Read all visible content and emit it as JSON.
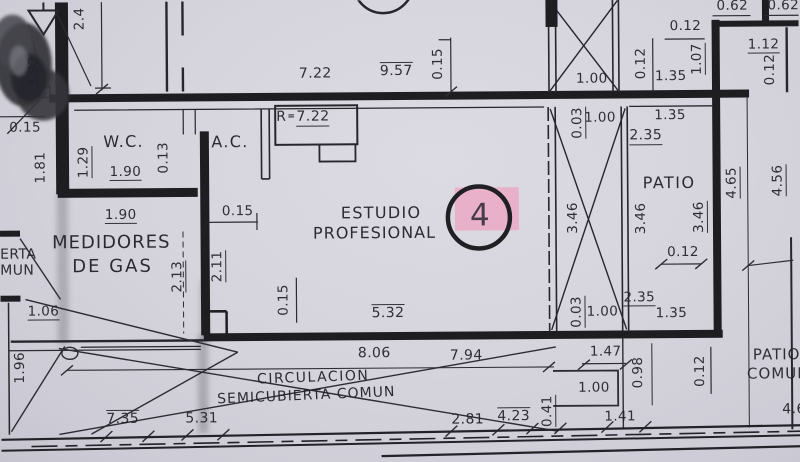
{
  "texts": {
    "wc": "W.C.",
    "ac": "A.C.",
    "estudio_1": "ESTUDIO",
    "estudio_2": "PROFESIONAL",
    "unit_number": "4",
    "medidores_1": "MEDIDORES",
    "medidores_2": "DE GAS",
    "patio": "PATIO",
    "circulacion_1": "CIRCULACION",
    "circulacion_2": "SEMICUBIERTA COMUN",
    "patio_comun_1": "PATIO",
    "patio_comun_2": "COMUN",
    "edge_erta": "ERTA",
    "edge_mun": "MUN",
    "radius_prefix": "R",
    "radius_eq": "=",
    "radius_value": "7.22"
  },
  "dims": {
    "top_24": "2.4",
    "top_722": "7.22",
    "top_957": "9.57",
    "top_015": "0.15",
    "tr_062_a": "0.62",
    "tr_062_b": "0.62",
    "tr_012_a": "0.12",
    "tr_012_b": "0.12",
    "tr_107": "1.07",
    "tr_135": "1.35",
    "tr_100": "1.00",
    "tr_112": "1.12",
    "tr_012_c": "0.12",
    "left_382": "3.82",
    "left_015": "0.15",
    "left_181": "1.81",
    "wc_129": "1.29",
    "wc_190": "1.90",
    "wc_013": "0.13",
    "med_190": "1.90",
    "med_213": "2.13",
    "med_106": "1.06",
    "med_196": "1.96",
    "ac_015": "0.15",
    "est_211": "2.11",
    "est_015": "0.15",
    "est_532": "5.32",
    "sh_003_t": "0.03",
    "sh_100_t": "1.00",
    "sh_346": "3.46",
    "pa_135_t": "1.35",
    "pa_235_t": "2.35",
    "pa_346_a": "3.46",
    "pa_346_b": "3.46",
    "pa_012": "0.12",
    "pa_235_b": "2.35",
    "pa_135_b": "1.35",
    "sh_003_b": "0.03",
    "sh_100_b": "1.00",
    "r_465": "4.65",
    "r_456": "4.56",
    "c_806": "8.06",
    "c_794": "7.94",
    "c_531": "5.31",
    "c_735": "7.35",
    "c_281": "2.81",
    "c_423": "4.23",
    "c_041": "0.41",
    "br_147": "1.47",
    "br_098": "0.98",
    "br_012": "0.12",
    "br_100": "1.00",
    "br_141": "1.41",
    "br_46": "4.6"
  },
  "colors": {
    "ink": "#1e1e24",
    "paper": "#d6d4dc",
    "highlight": "#eba9c5"
  }
}
